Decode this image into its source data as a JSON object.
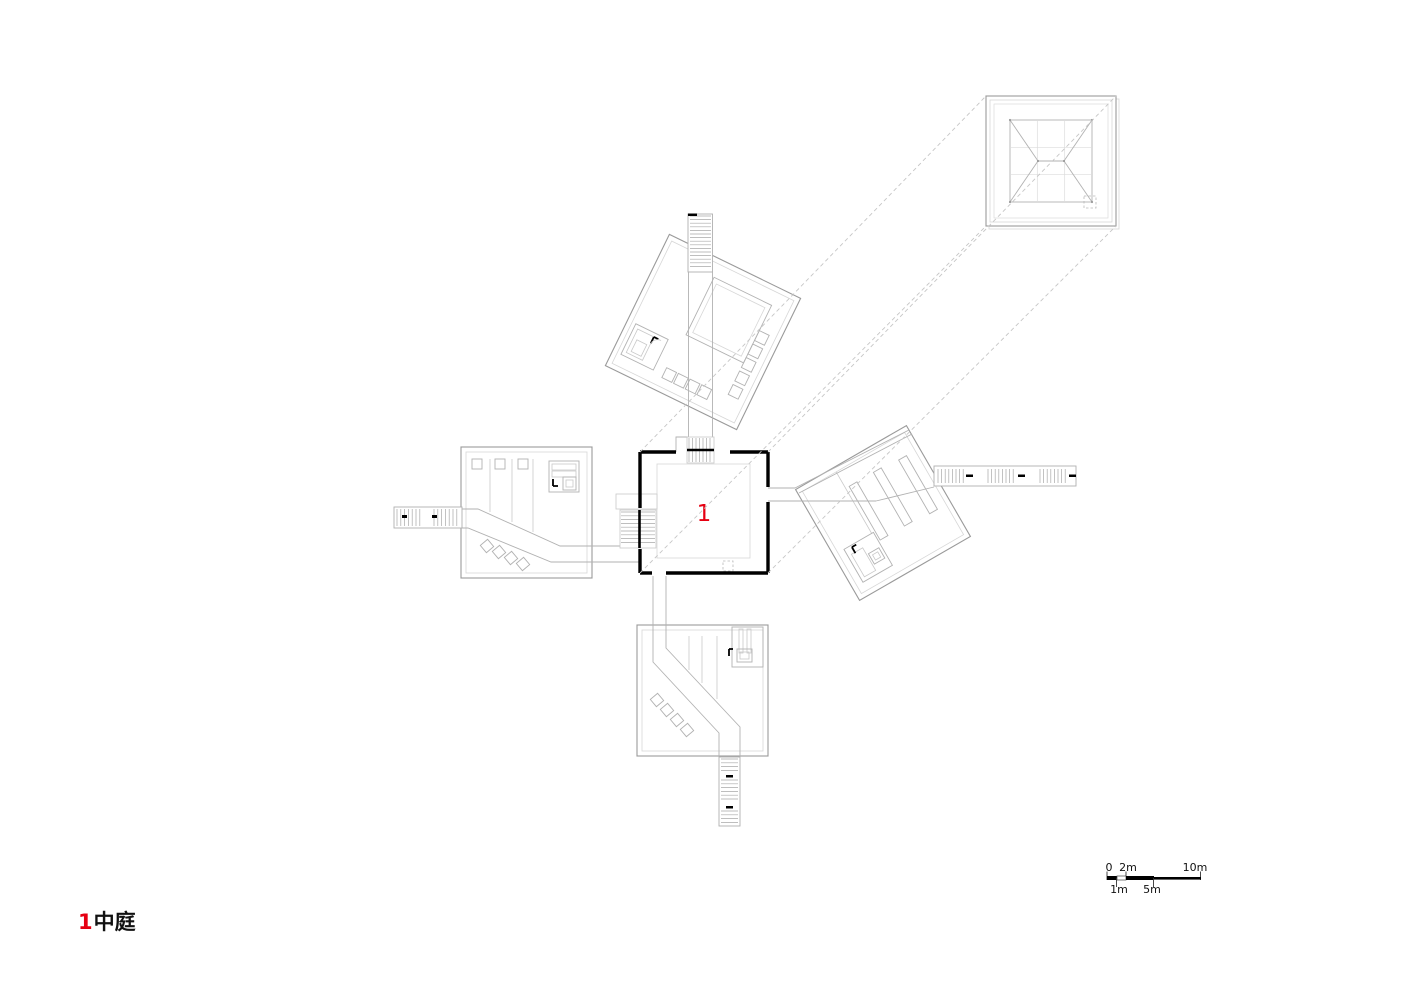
{
  "caption": {
    "number": "1",
    "text": "中庭"
  },
  "courtyard": {
    "label": "1"
  },
  "scale_bar": {
    "zero": "0",
    "two_m": "2m",
    "ten_m": "10m",
    "one_m": "1m",
    "five_m": "5m"
  },
  "colors": {
    "accent_red": "#e60012",
    "wall_black": "#000000",
    "line_mid": "#9a9a9a",
    "line_light": "#c9c9c9",
    "background": "#ffffff"
  }
}
